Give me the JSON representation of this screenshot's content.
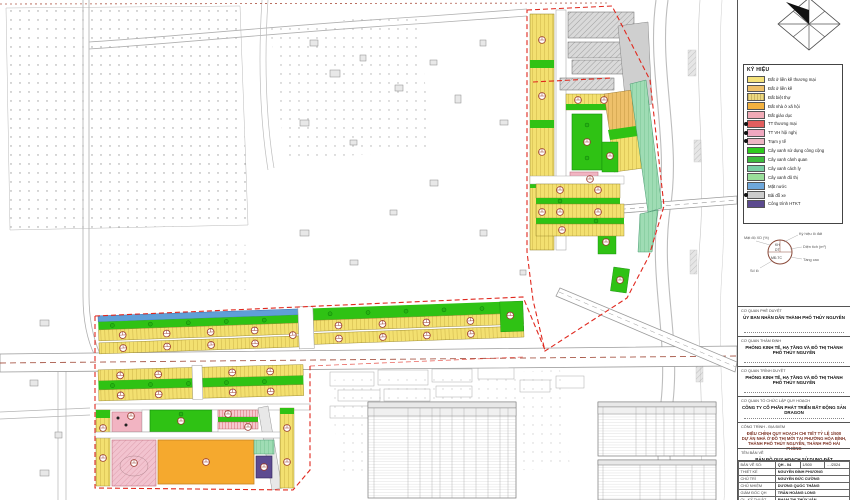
{
  "document": {
    "type": "urban planning drawing",
    "drawing_name": "BẢN ĐỒ QUY HOẠCH SỬ DỤNG ĐẤT"
  },
  "colors": {
    "boundary": "#e0281e",
    "water": "#5f9fd8",
    "public_green": "#2fc214",
    "social_housing_orange": "#f5a92e",
    "htkt_purple": "#5d4b91"
  },
  "legend": {
    "title": "KÝ HIỆU",
    "items": [
      {
        "label": "Đất ở liền kề thương mại",
        "color": "#f5e27a"
      },
      {
        "label": "Đất ở liền kề",
        "color": "#eec06a"
      },
      {
        "label": "Đất biệt thự",
        "color": "#ecd880"
      },
      {
        "label": "Đất nhà ở xã hội",
        "color": "#f2b13f"
      },
      {
        "label": "Đất giáo dục",
        "color": "#f0aab6"
      },
      {
        "label": "TT thương mại",
        "color": "#e25e5e"
      },
      {
        "label": "TT VH hội nghị",
        "color": "#f0a8c0"
      },
      {
        "label": "Trạm y tế",
        "color": "#eeb6c4"
      },
      {
        "label": "Cây xanh sử dụng công cộng",
        "color": "#2ecc1e"
      },
      {
        "label": "Cây xanh cảnh quan",
        "color": "#3dbb3d"
      },
      {
        "label": "Cây xanh cách ly",
        "color": "#79cfa4"
      },
      {
        "label": "Cây xanh đô thị",
        "color": "#9adf9a"
      },
      {
        "label": "Mặt nước",
        "color": "#6fa8dc"
      },
      {
        "label": "Bãi đỗ xe",
        "color": "#cccccc"
      },
      {
        "label": "Công trình HTKT",
        "color": "#5b4a8e"
      }
    ]
  },
  "symbol_key": {
    "inner_top": "KH",
    "inner_mid": "DT",
    "inner_bot": "MĐ-TC",
    "label_top": "Ký hiệu lô đất",
    "label_right1": "Diện tích (m²)",
    "label_right2": "Tầng cao",
    "label_left": "Mật độ XD (%)",
    "label_bottom": "Số lô"
  },
  "title_block": {
    "sections": [
      {
        "heading": "CƠ QUAN PHÊ DUYỆT",
        "body": "ỦY BAN NHÂN DÂN THÀNH PHỐ THỦY NGUYÊN"
      },
      {
        "heading": "CƠ QUAN THẨM ĐỊNH",
        "body": "PHÒNG KINH TẾ, HẠ TẦNG VÀ ĐÔ THỊ THÀNH PHỐ THỦY NGUYÊN"
      },
      {
        "heading": "CƠ QUAN TRÌNH DUYỆT",
        "body": "PHÒNG KINH TẾ, HẠ TẦNG VÀ ĐÔ THỊ THÀNH PHỐ THỦY NGUYÊN"
      },
      {
        "heading": "CƠ QUAN TỔ CHỨC LẬP QUY HOẠCH",
        "body": "CÔNG TY CỔ PHẦN PHÁT TRIỂN BẤT ĐỘNG SẢN DRAGON"
      }
    ],
    "project": {
      "heading": "CÔNG TRÌNH - ĐỊA ĐIỂM",
      "line1": "ĐIỀU CHỈNH QUY HOẠCH CHI TIẾT TỶ LỆ 1/500",
      "line2": "DỰ ÁN NHÀ Ở ĐÔ THỊ MỚI TẠI PHƯỜNG HÒA BÌNH,",
      "line3": "THÀNH PHỐ THỦY NGUYÊN, THÀNH PHỐ HẢI PHÒNG"
    },
    "drawing": {
      "heading": "TÊN BẢN VẼ",
      "name": "BẢN ĐỒ QUY HOẠCH SỬ DỤNG ĐẤT"
    },
    "staff": {
      "meta": {
        "sheet_label": "BẢN VẼ SỐ:",
        "sheet_no": "QH - 04",
        "scale_label": "TỶ LỆ:",
        "scale": "1/500",
        "date_label": "NGÀY:",
        "date": "…/2024"
      },
      "rows": [
        {
          "role": "THIẾT KẾ",
          "name": "NGUYỄN ĐÌNH PHƯƠNG"
        },
        {
          "role": "CHỦ TRÌ",
          "name": "NGUYỄN ĐỨC CƯỜNG"
        },
        {
          "role": "CHỦ NHIỆM",
          "name": "DƯƠNG QUỐC THẮNG"
        },
        {
          "role": "GIÁM ĐỐC QH",
          "name": "TRẦN HOÀNG LONG"
        },
        {
          "role": "QL. KỸ THUẬT",
          "name": "PHẠM THỊ THỦY VÂN"
        }
      ]
    }
  }
}
